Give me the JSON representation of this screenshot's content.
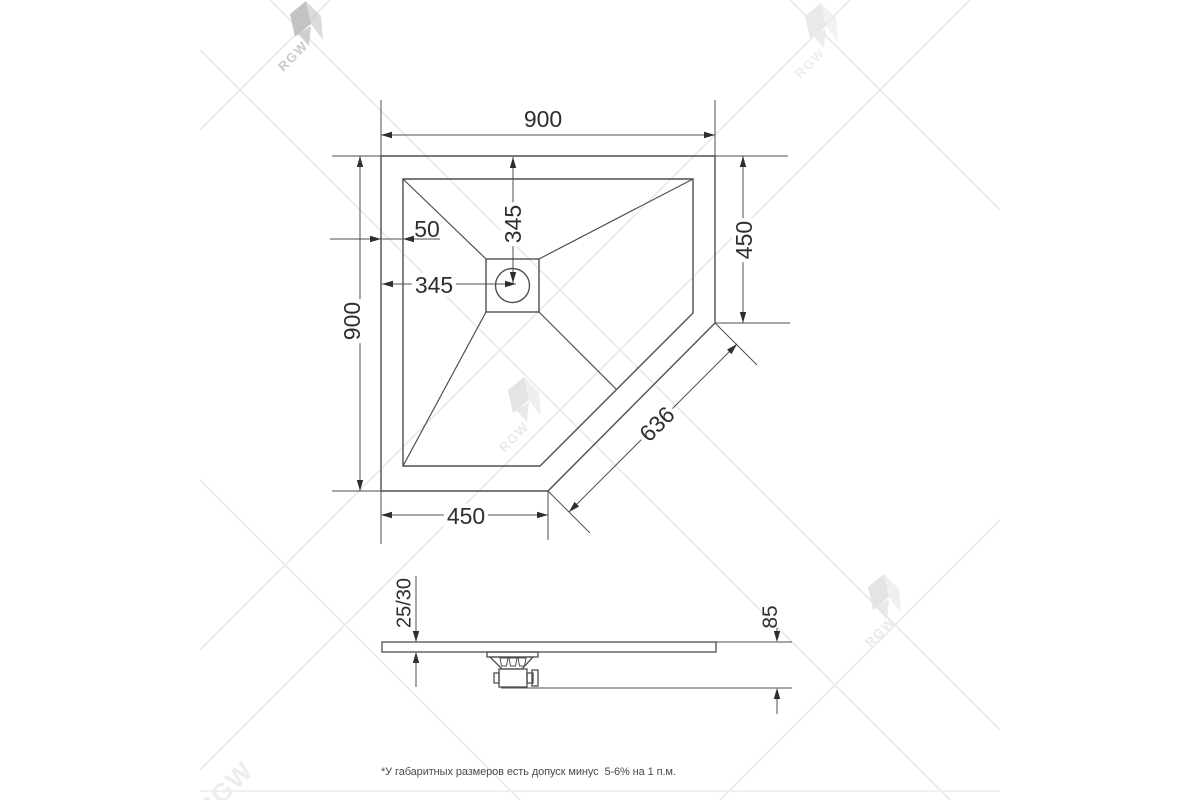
{
  "watermark": {
    "brand": "RGW"
  },
  "plan_view": {
    "width_top": "900",
    "height_left": "900",
    "right_side_height": "450",
    "bottom_side_width": "450",
    "diagonal_width": "636",
    "rim_offset": "50",
    "drain_center_from_left": "345",
    "drain_center_from_top": "345"
  },
  "side_view": {
    "tray_thickness": "25/30",
    "height_with_drain": "85"
  },
  "footnote": "*У габаритных размеров есть допуск минус  5-6% на 1 п.м.",
  "colors": {
    "line": "#4f4f4f",
    "text": "#2e2e2e",
    "watermark_line": "#ececec",
    "watermark_logo": "#c9c9c9"
  }
}
